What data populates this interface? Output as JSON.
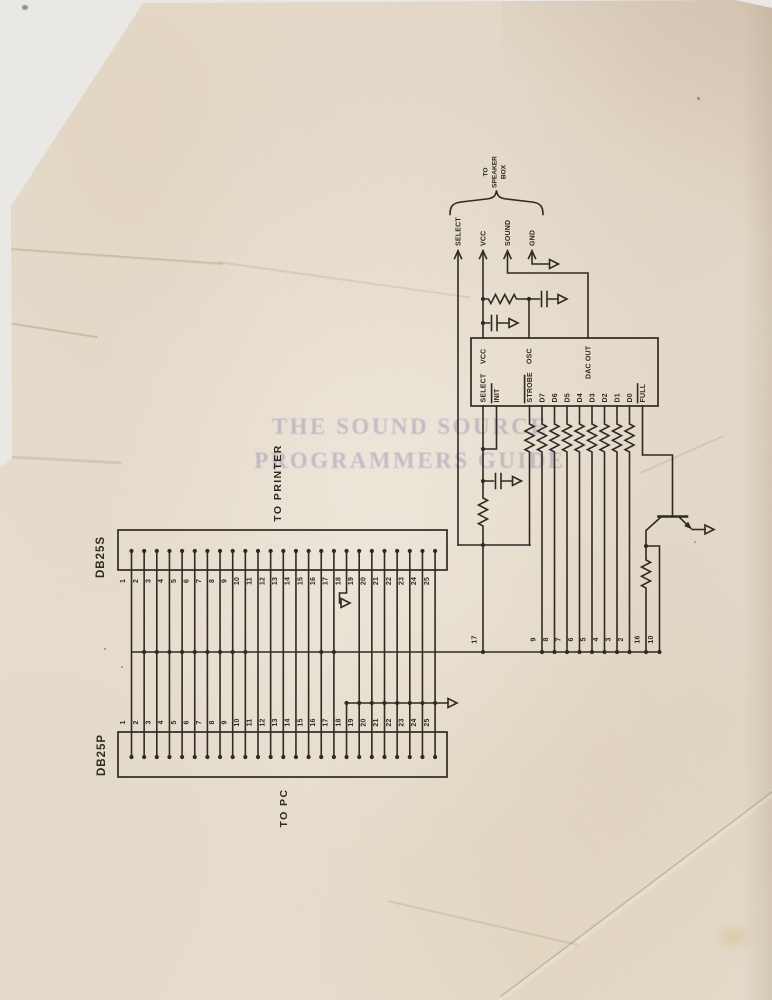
{
  "page": {
    "background_color": "#e9e8e5",
    "paper_color": "#e7dfd1",
    "ink_color": "#2e2a24",
    "watermark_color": "#7d76a8",
    "watermark_line1": "THE SOUND SOURCE",
    "watermark_line2": "PROGRAMMERS GUIDE"
  },
  "speaker_header": {
    "label_lines": [
      "TO",
      "SPEAKER",
      "BOX"
    ],
    "signals": [
      "SELECT",
      "VCC",
      "SOUND",
      "GND"
    ]
  },
  "ic": {
    "top_pins": [
      "VCC",
      "OSC",
      "DAC OUT"
    ],
    "bottom_pins": [
      {
        "label": "SELECT",
        "overline": false
      },
      {
        "label": "INIT",
        "overline": true
      },
      {
        "label": "STROBE",
        "overline": true
      },
      {
        "label": "D7",
        "overline": false
      },
      {
        "label": "D6",
        "overline": false
      },
      {
        "label": "D5",
        "overline": false
      },
      {
        "label": "D4",
        "overline": false
      },
      {
        "label": "D3",
        "overline": false
      },
      {
        "label": "D2",
        "overline": false
      },
      {
        "label": "D1",
        "overline": false
      },
      {
        "label": "D0",
        "overline": false
      },
      {
        "label": "FULL",
        "overline": true
      }
    ]
  },
  "bus_labels": [
    "17",
    "9",
    "8",
    "7",
    "6",
    "5",
    "4",
    "3",
    "2",
    "16",
    "10"
  ],
  "db25s": {
    "name": "DB25S",
    "caption": "TO PRINTER",
    "pins": [
      "1",
      "2",
      "3",
      "4",
      "5",
      "6",
      "7",
      "8",
      "9",
      "10",
      "11",
      "12",
      "13",
      "14",
      "15",
      "16",
      "17",
      "18",
      "19",
      "20",
      "21",
      "22",
      "23",
      "24",
      "25"
    ]
  },
  "db25p": {
    "name": "DB25P",
    "caption": "TO PC",
    "pins": [
      "1",
      "2",
      "3",
      "4",
      "5",
      "6",
      "7",
      "8",
      "9",
      "10",
      "11",
      "12",
      "13",
      "14",
      "15",
      "16",
      "17",
      "18",
      "19",
      "20",
      "21",
      "22",
      "23",
      "24",
      "25"
    ]
  }
}
